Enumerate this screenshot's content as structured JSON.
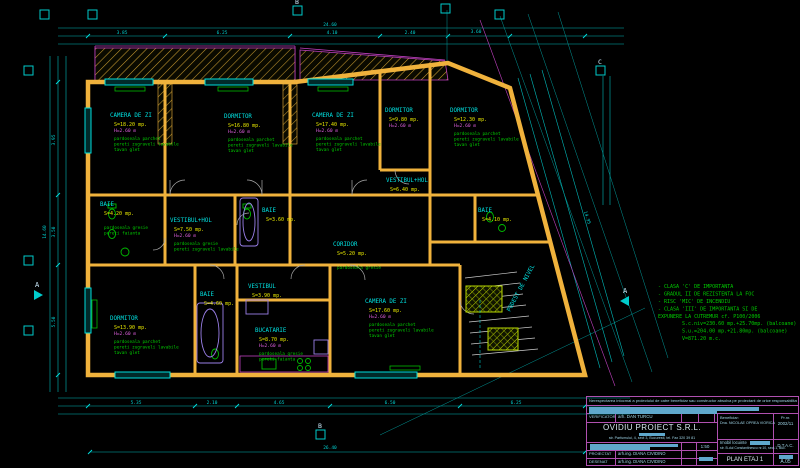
{
  "canvas": {
    "width": 800,
    "height": 468,
    "background": "#000000"
  },
  "colors": {
    "walls": "#f0b23c",
    "dims": "#00cccc",
    "room_name": "#00e0e0",
    "area_text": "#e8e800",
    "height_text": "#e060e0",
    "finish_notes": "#00cc00",
    "magenta_lines": "#c040c0",
    "title_border": "#b050b0",
    "highlight": "#5fa8cc"
  },
  "plan": {
    "rooms": [
      {
        "label": "CAMERA DE ZI",
        "x": 110,
        "y": 117,
        "area": "S=18.20 mp.",
        "h": "H=2.60 m",
        "notes": [
          "pardoseala parchet",
          "pereti zugraveli lavabile",
          "tavan glet"
        ],
        "rot": 0
      },
      {
        "label": "DORMITOR",
        "x": 224,
        "y": 118,
        "area": "S=16.80 mp.",
        "h": "H=2.60 m",
        "notes": [
          "pardoseala parchet",
          "pereti zugraveli lavabile",
          "tavan glet"
        ],
        "rot": 0
      },
      {
        "label": "CAMERA DE ZI",
        "x": 312,
        "y": 117,
        "area": "S=17.40 mp.",
        "h": "H=2.60 m",
        "notes": [
          "pardoseala parchet",
          "pereti zugraveli lavabile",
          "tavan glet"
        ],
        "rot": 0
      },
      {
        "label": "DORMITOR",
        "x": 385,
        "y": 112,
        "area": "S=9.80 mp.",
        "h": "H=2.60 m",
        "notes": [],
        "rot": 0
      },
      {
        "label": "DORMITOR",
        "x": 450,
        "y": 112,
        "area": "S=12.30 mp.",
        "h": "H=2.60 m",
        "notes": [
          "pardoseala parchet",
          "pereti zugraveli lavabile",
          "tavan glet"
        ],
        "rot": 0
      },
      {
        "label": "VESTIBUL+HOL",
        "x": 170,
        "y": 222,
        "area": "S=7.50 mp.",
        "h": "H=2.60 m",
        "notes": [
          "pardoseala gresie",
          "pereti zugraveli lavabile"
        ],
        "rot": 0
      },
      {
        "label": "VESTIBUL+HOL",
        "x": 386,
        "y": 182,
        "area": "S=6.40 mp.",
        "h": "",
        "notes": [],
        "rot": 0
      },
      {
        "label": "BAIE",
        "x": 100,
        "y": 206,
        "area": "S=4.20 mp.",
        "h": "",
        "notes": [
          "pardoseala gresie",
          "pereti faianta"
        ],
        "rot": 0
      },
      {
        "label": "BAIE",
        "x": 262,
        "y": 212,
        "area": "S=3.60 mp.",
        "h": "",
        "notes": [],
        "rot": 0
      },
      {
        "label": "BAIE",
        "x": 478,
        "y": 212,
        "area": "S=4.10 mp.",
        "h": "",
        "notes": [],
        "rot": 0
      },
      {
        "label": "CORIDOR",
        "x": 333,
        "y": 246,
        "area": "S=5.20 mp.",
        "h": "",
        "notes": [
          "pardoseala gresie"
        ],
        "rot": 0
      },
      {
        "label": "VESTIBUL",
        "x": 248,
        "y": 288,
        "area": "S=3.90 mp.",
        "h": "",
        "notes": [],
        "rot": 0
      },
      {
        "label": "BAIE",
        "x": 200,
        "y": 296,
        "area": "S=4.60 mp.",
        "h": "",
        "notes": [],
        "rot": 0
      },
      {
        "label": "BUCATARIE",
        "x": 255,
        "y": 332,
        "area": "S=8.70 mp.",
        "h": "H=2.60 m",
        "notes": [
          "pardoseala gresie",
          "pereti faianta"
        ],
        "rot": 0
      },
      {
        "label": "DORMITOR",
        "x": 110,
        "y": 320,
        "area": "S=13.90 mp.",
        "h": "H=2.60 m",
        "notes": [
          "pardoseala parchet",
          "pereti zugraveli lavabile",
          "tavan glet"
        ],
        "rot": 0
      },
      {
        "label": "CAMERA DE ZI",
        "x": 365,
        "y": 303,
        "area": "S=17.60 mp.",
        "h": "H=2.60 m",
        "notes": [
          "pardoseala parchet",
          "pereti zugraveli lavabile",
          "tavan glet"
        ],
        "rot": 0
      },
      {
        "label": "PODEST DE NIVEL",
        "x": 510,
        "y": 312,
        "area": "",
        "h": "",
        "notes": [],
        "rot": -62
      }
    ],
    "dims": [
      {
        "t": "3.85",
        "x": 122,
        "y": 34,
        "rot": 0
      },
      {
        "t": "6.25",
        "x": 222,
        "y": 34,
        "rot": 0
      },
      {
        "t": "4.10",
        "x": 332,
        "y": 34,
        "rot": 0
      },
      {
        "t": "2.40",
        "x": 410,
        "y": 34,
        "rot": 0
      },
      {
        "t": "3.60",
        "x": 476,
        "y": 33,
        "rot": 0
      },
      {
        "t": "24.60",
        "x": 330,
        "y": 26,
        "rot": 0
      },
      {
        "t": "5.35",
        "x": 136,
        "y": 404,
        "rot": 0
      },
      {
        "t": "2.10",
        "x": 212,
        "y": 404,
        "rot": 0
      },
      {
        "t": "4.65",
        "x": 279,
        "y": 404,
        "rot": 0
      },
      {
        "t": "6.50",
        "x": 390,
        "y": 404,
        "rot": 0
      },
      {
        "t": "6.25",
        "x": 516,
        "y": 404,
        "rot": 0
      },
      {
        "t": "26.40",
        "x": 330,
        "y": 449,
        "rot": 0
      },
      {
        "t": "3.95",
        "x": 55,
        "y": 140,
        "rot": -90
      },
      {
        "t": "3.50",
        "x": 55,
        "y": 232,
        "rot": -90
      },
      {
        "t": "5.50",
        "x": 55,
        "y": 322,
        "rot": -90
      },
      {
        "t": "14.60",
        "x": 46,
        "y": 232,
        "rot": -90
      },
      {
        "t": "14.95",
        "x": 586,
        "y": 218,
        "rot": 72
      }
    ],
    "markers": [
      {
        "label": "",
        "x": 40,
        "y": 10,
        "type": "sq"
      },
      {
        "label": "",
        "x": 88,
        "y": 10,
        "type": "sq"
      },
      {
        "label": "B",
        "x": 293,
        "y": 6,
        "type": "sq"
      },
      {
        "label": "",
        "x": 441,
        "y": 4,
        "type": "sq"
      },
      {
        "label": "",
        "x": 495,
        "y": 10,
        "type": "sq"
      },
      {
        "label": "C",
        "x": 596,
        "y": 66,
        "type": "sq"
      },
      {
        "label": "B",
        "x": 316,
        "y": 430,
        "type": "sq"
      },
      {
        "label": "",
        "x": 24,
        "y": 66,
        "type": "sq"
      },
      {
        "label": "",
        "x": 24,
        "y": 256,
        "type": "sq"
      },
      {
        "label": "",
        "x": 24,
        "y": 326,
        "type": "sq"
      },
      {
        "label": "A",
        "x": 34,
        "y": 290,
        "type": "sectionR"
      },
      {
        "label": "A",
        "x": 620,
        "y": 296,
        "type": "sectionL"
      }
    ],
    "notes_block": {
      "x": 658,
      "y": 288,
      "lines": [
        "- CLASA 'C' DE IMPORTANTA",
        "- GRADUL II DE REZISTENTA LA FOC",
        "- RISC 'MIC' DE INCENDIU",
        "- CLASA 'III' DE IMPORTANTA SI DE",
        "  EXPUNERE LA CUTREMUR  cf. P100/2006"
      ],
      "areas_x": 682,
      "areas_y": 325,
      "areas": [
        "S.c.niv=230.60 mp.+25.70mp. (balcoane)",
        "S.u.=204.00 mp.+21.80mp. (balcoane)",
        "V=871.20 m.c."
      ]
    }
  },
  "title_block": {
    "disclaimer": "Nerespectarea intocmai a proiectului de catre beneficiar sau constructor absolva pe proiectant de orice responsabilitate.",
    "verificator_label": "VERIFICATOR",
    "verificator_name": "arh. DAN TURCU",
    "company": "OVIDIU PROIECT S.R.L.",
    "address": "str. Parfumului, 4, sect 3, Bucuresti, tel. Fax 320 39 81",
    "beneficiar_label": "Beneficiar:",
    "beneficiar_name": "Dna. NICOLAE OPREA VIORICA",
    "pr_label": "Pr.nr.",
    "pr_value": "2002/11",
    "scale": "1:50",
    "project_title": "Imobil locuinte",
    "project_addr": "str. B-dul Constantinescu nr.10, sect.1, Buc.",
    "phase": "D.T.A.C.",
    "proiectat_label": "PROIECTAT",
    "proiectat_name": "arh.ing. DIANA CIVIDINO",
    "desenat_label": "DESENAT",
    "desenat_name": "arh.ing. DIANA CIVIDINO",
    "sheet_title": "PLAN ETAJ 1",
    "sheet_no": "A.05"
  }
}
